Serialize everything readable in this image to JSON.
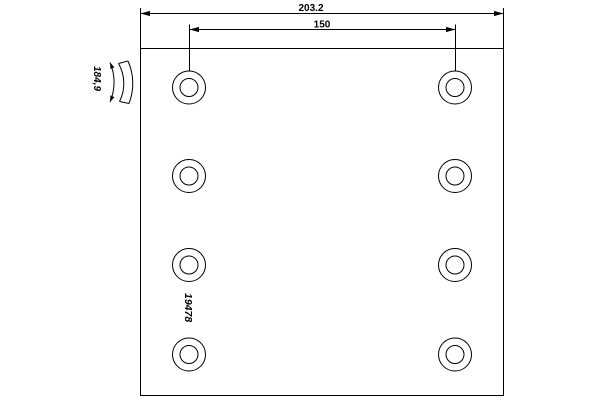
{
  "drawing": {
    "labels": {
      "overall_width": "203.2",
      "hole_spacing": "150",
      "radius": "184,9",
      "part_number": "19478"
    },
    "holes": {
      "count": 8,
      "columns": 2,
      "rows": 4
    },
    "colors": {
      "line": "#000000",
      "background": "#ffffff"
    }
  }
}
